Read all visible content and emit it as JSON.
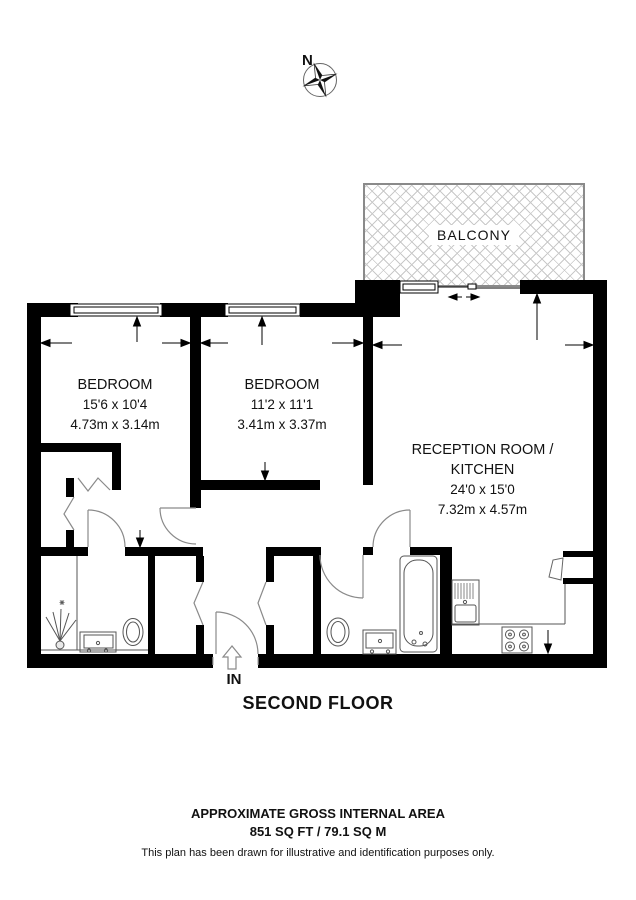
{
  "compass": {
    "north_label": "N"
  },
  "balcony": {
    "label": "BALCONY"
  },
  "rooms": {
    "bedroom1": {
      "name": "BEDROOM",
      "imperial": "15'6 x 10'4",
      "metric": "4.73m x 3.14m"
    },
    "bedroom2": {
      "name": "BEDROOM",
      "imperial": "11'2 x 11'1",
      "metric": "3.41m x 3.37m"
    },
    "reception": {
      "name_line1": "RECEPTION ROOM /",
      "name_line2": "KITCHEN",
      "imperial": "24'0 x 15'0",
      "metric": "7.32m x 4.57m"
    }
  },
  "entrance": {
    "label": "IN"
  },
  "floor": {
    "title": "SECOND FLOOR"
  },
  "footer": {
    "line1": "APPROXIMATE GROSS INTERNAL AREA",
    "line2": "851 SQ FT / 79.1 SQ M",
    "disclaimer": "This plan has been drawn for illustrative and identification purposes only."
  },
  "icons": {
    "compass": "compass-rose-icon",
    "entrance_arrow": "in-arrow-icon",
    "fixtures": [
      "bathtub-icon",
      "toilet-icon",
      "toilet-icon",
      "vanity-sink-icon",
      "vanity-sink-icon",
      "shower-icon",
      "kitchen-sink-icon",
      "hob-icon"
    ]
  },
  "colors": {
    "wall": "#000000",
    "door_line": "#8a8a8a",
    "fixture_line": "#555555",
    "hatch": "#c9c9c9"
  }
}
